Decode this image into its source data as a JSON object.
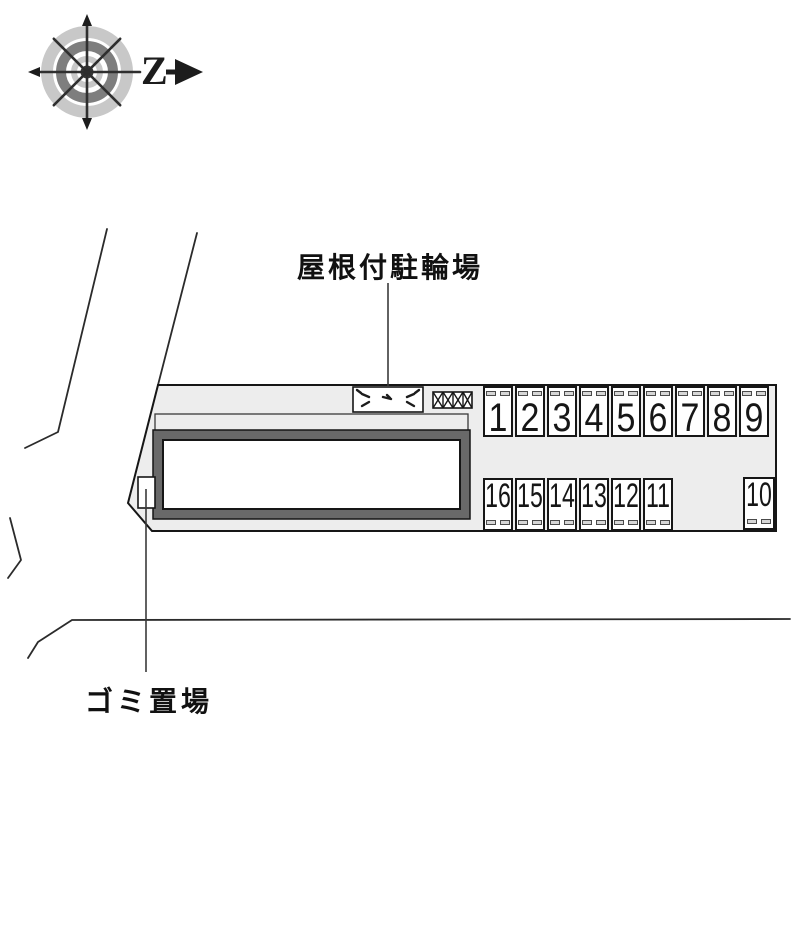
{
  "compass": {
    "north_label": "Z"
  },
  "labels": {
    "bicycle_parking": "屋根付駐輪場",
    "garbage_area": "ゴミ置場"
  },
  "parking": {
    "top_row": [
      "1",
      "2",
      "3",
      "4",
      "5",
      "6",
      "7",
      "8",
      "9"
    ],
    "bottom_row": [
      "16",
      "15",
      "14",
      "13",
      "12",
      "11"
    ],
    "isolated_space": "10"
  },
  "colors": {
    "site_fill": "#ededed",
    "building_wall": "#696969",
    "outline": "#161616",
    "ring_light": "#c8c8c8",
    "ring_dark": "#7e7e7e"
  }
}
